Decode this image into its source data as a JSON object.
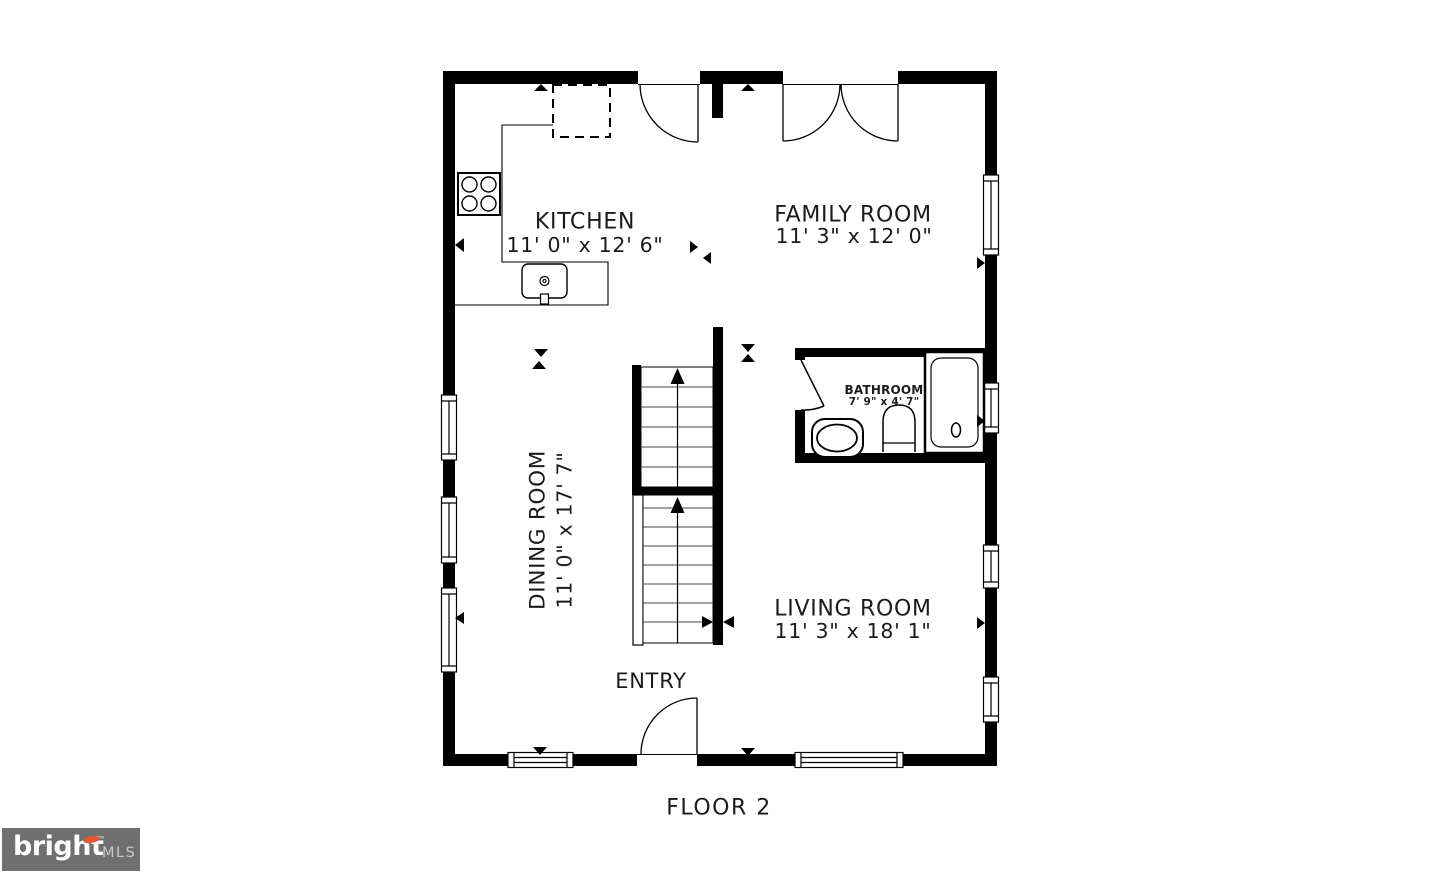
{
  "floor_plan": {
    "floor_label": "FLOOR 2",
    "rooms": [
      {
        "id": "kitchen",
        "name": "KITCHEN",
        "dimensions": "11' 0\" x 12' 6\""
      },
      {
        "id": "family-room",
        "name": "FAMILY ROOM",
        "dimensions": "11' 3\" x 12' 0\""
      },
      {
        "id": "dining-room",
        "name": "DINING ROOM",
        "dimensions": "11' 0\" x 17' 7\""
      },
      {
        "id": "bathroom",
        "name": "BATHROOM",
        "dimensions": "7' 9\" x 4' 7\""
      },
      {
        "id": "living-room",
        "name": "LIVING ROOM",
        "dimensions": "11' 3\" x 18' 1\""
      },
      {
        "id": "entry",
        "name": "ENTRY",
        "dimensions": ""
      }
    ],
    "fixtures": [
      "stove",
      "kitchen-sink",
      "refrigerator",
      "toilet",
      "pedestal-sink",
      "bathtub",
      "staircase-upper",
      "staircase-lower"
    ],
    "colors": {
      "wall": "#000000",
      "line": "#000000",
      "background": "#ffffff"
    }
  },
  "branding": {
    "logo_text": "bright",
    "logo_trademark": "™",
    "logo_suffix": "MLS",
    "logo_background": "#6f6f6f",
    "logo_accent": "#e4572e",
    "logo_text_color": "#ffffff"
  }
}
